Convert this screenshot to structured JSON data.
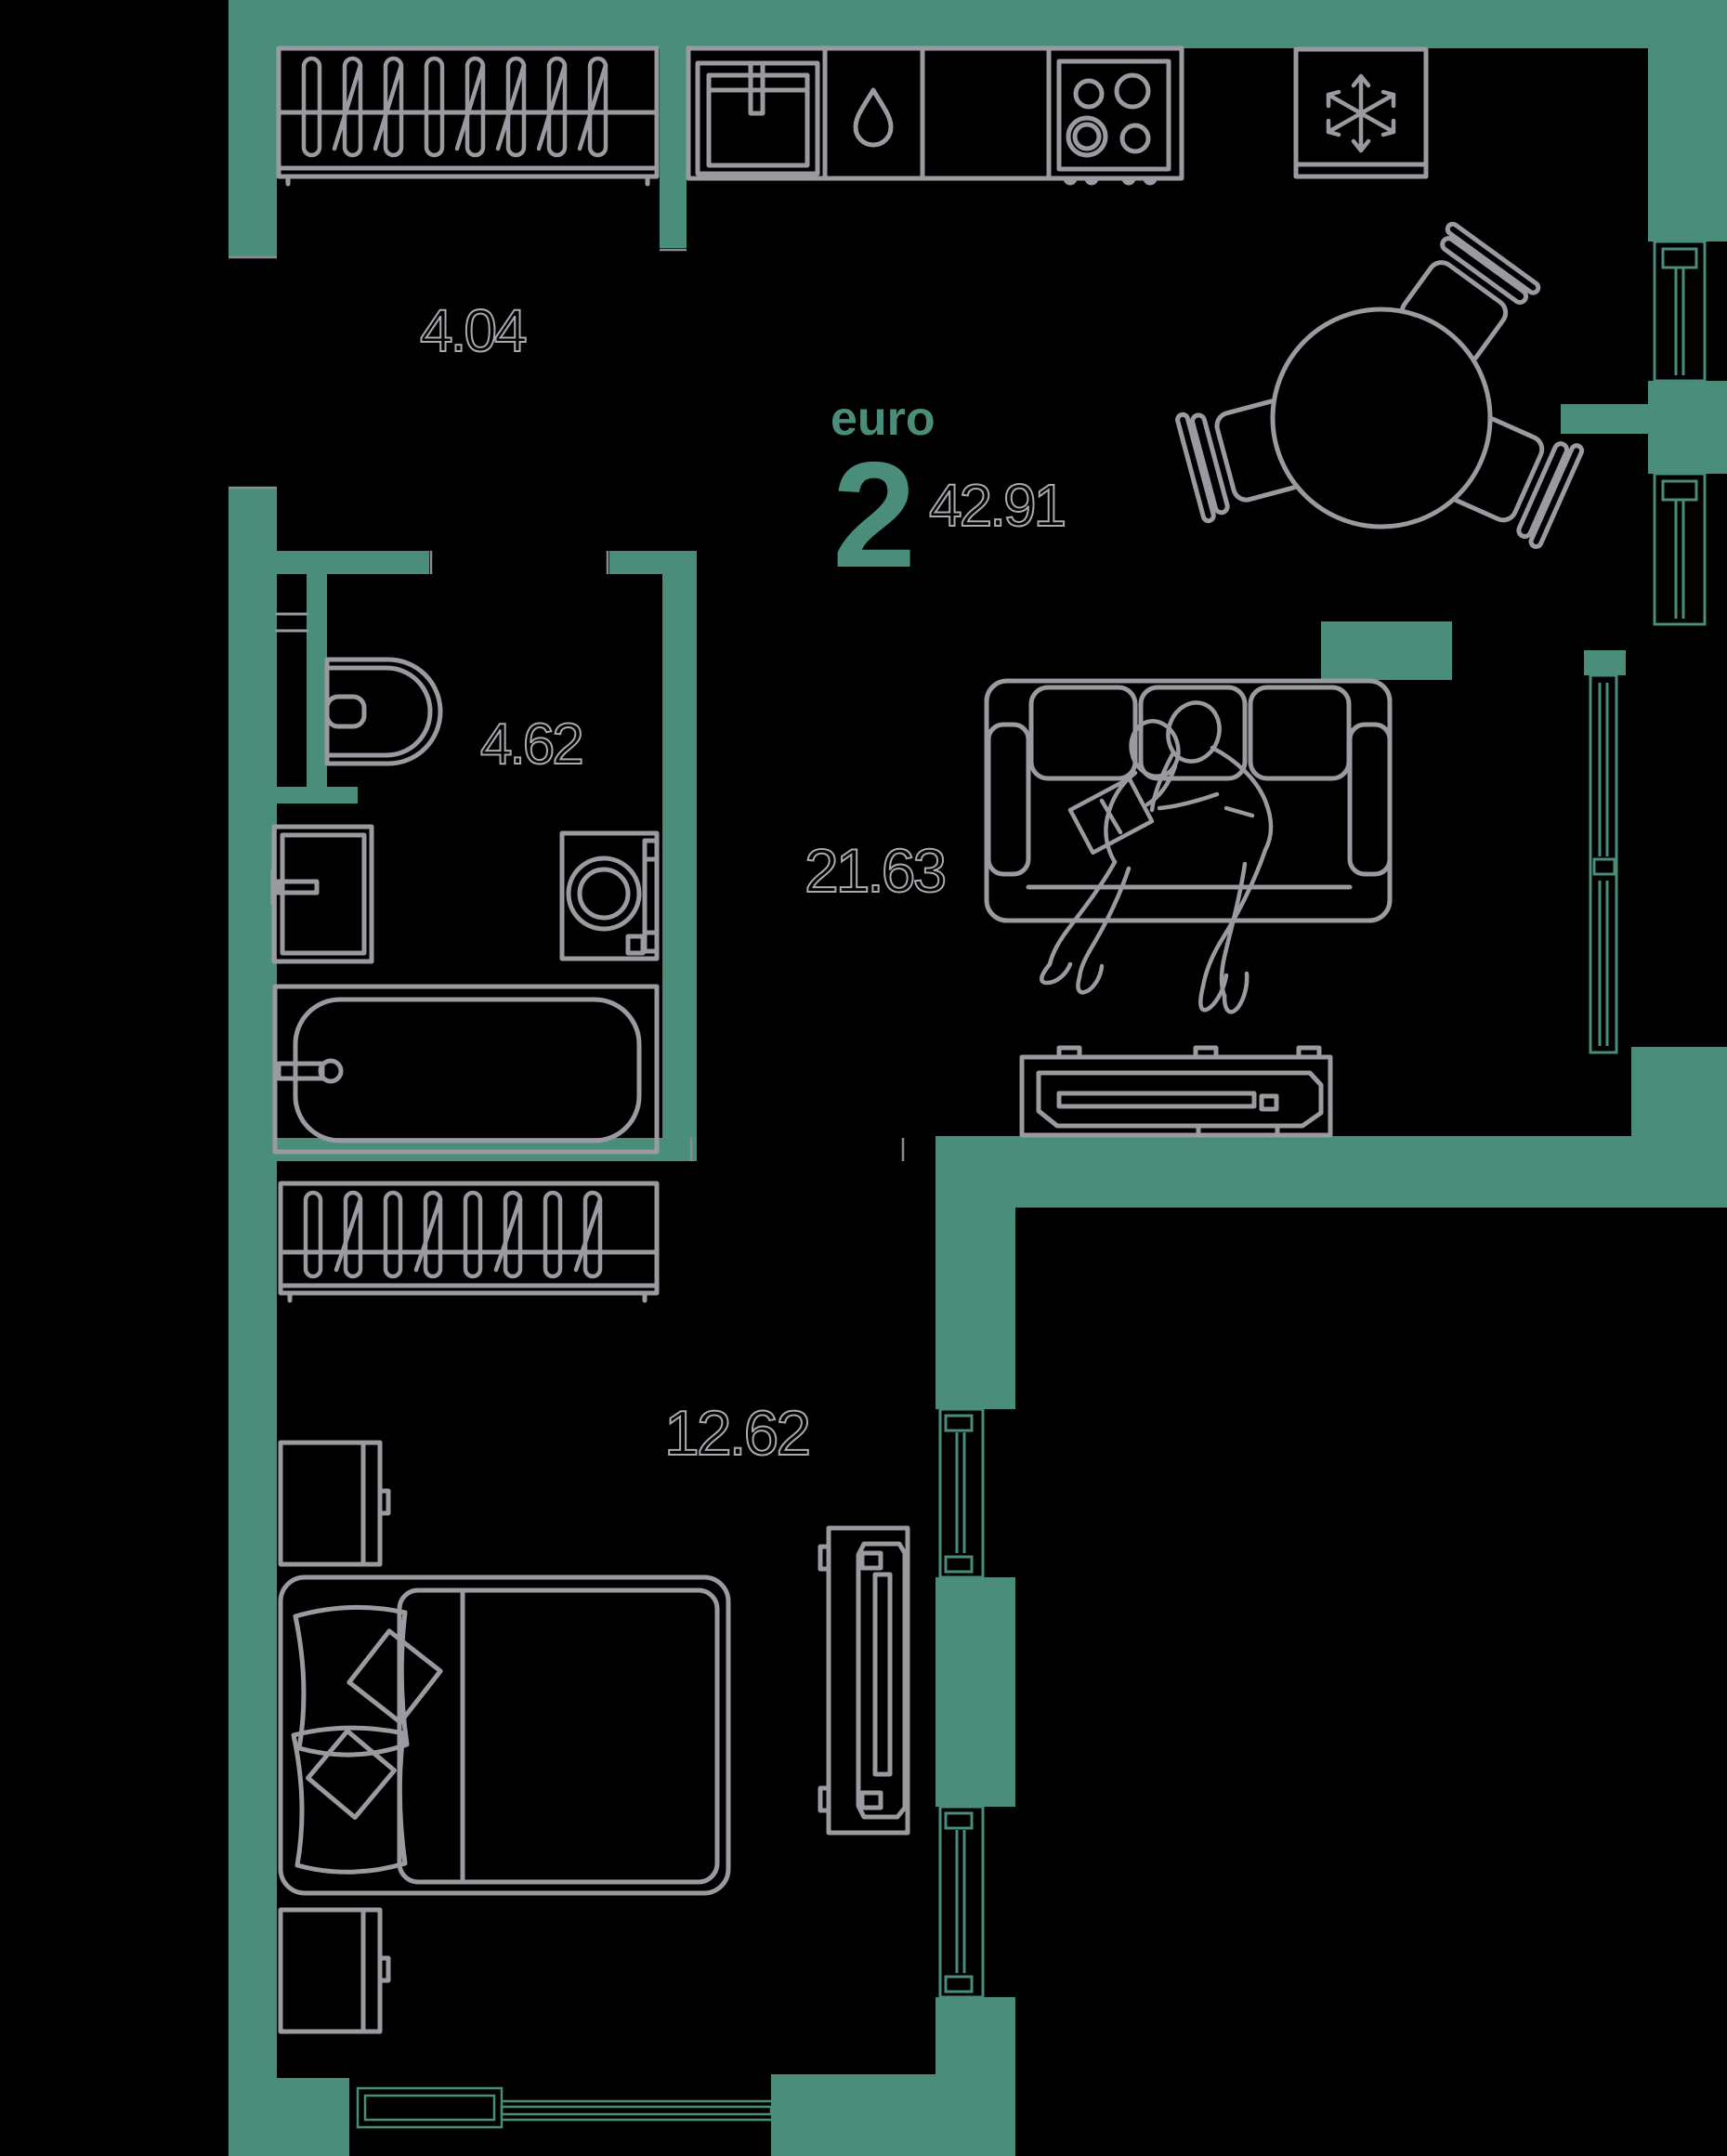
{
  "plan": {
    "title": {
      "type_label": "euro",
      "type_number": "2",
      "total_area": "42.91"
    },
    "rooms": [
      {
        "id": "hallway",
        "area_label": "4.04"
      },
      {
        "id": "bathroom",
        "area_label": "4.62"
      },
      {
        "id": "living-kitchen",
        "area_label": "21.63"
      },
      {
        "id": "bedroom",
        "area_label": "12.62"
      }
    ],
    "colors": {
      "background": "#000000",
      "wall": "#4a8d7b",
      "window_line": "#4a8d7b",
      "furniture_line": "#9a9aa1",
      "label_outline": "#a9a9af",
      "accent": "#4a8d7b"
    },
    "icons": [
      "snowflake-icon",
      "water-drop-icon",
      "stove-burners-icon",
      "sink-icon",
      "toilet-icon",
      "bathtub-icon",
      "washing-machine-icon",
      "wardrobe-hangers-icon",
      "double-bed-icon",
      "sofa-icon",
      "tv-stand-icon",
      "round-table-icon",
      "chair-icon",
      "people-reading-icon"
    ]
  }
}
